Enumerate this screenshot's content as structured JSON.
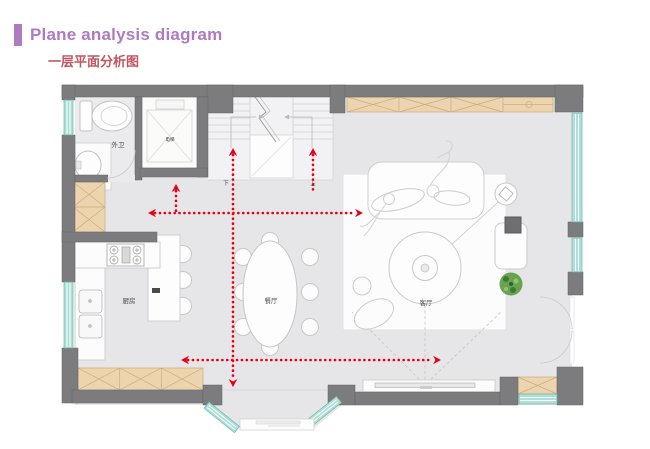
{
  "header": {
    "title": "Plane analysis diagram",
    "subtitle": "一层平面分析图"
  },
  "plan": {
    "rooms": {
      "bathroom": "外卫",
      "kitchen": "厨房",
      "dining": "餐厅",
      "living": "客厅",
      "elevator": "电梯"
    },
    "stairs": {
      "down": "下",
      "up": "上"
    }
  },
  "colors": {
    "accent_purple": "#b07ac3",
    "subtitle_red": "#c1565f",
    "arrow_red": "#e60014",
    "wall_gray": "#7c7c7e",
    "window_teal": "#aedfd8",
    "window_edge": "#6db7ab",
    "cabinet_tan": "#ecd5ae",
    "cabinet_line": "#cbab7c",
    "floor_gray": "#e6e5e7",
    "plant_green": "#69a351"
  }
}
